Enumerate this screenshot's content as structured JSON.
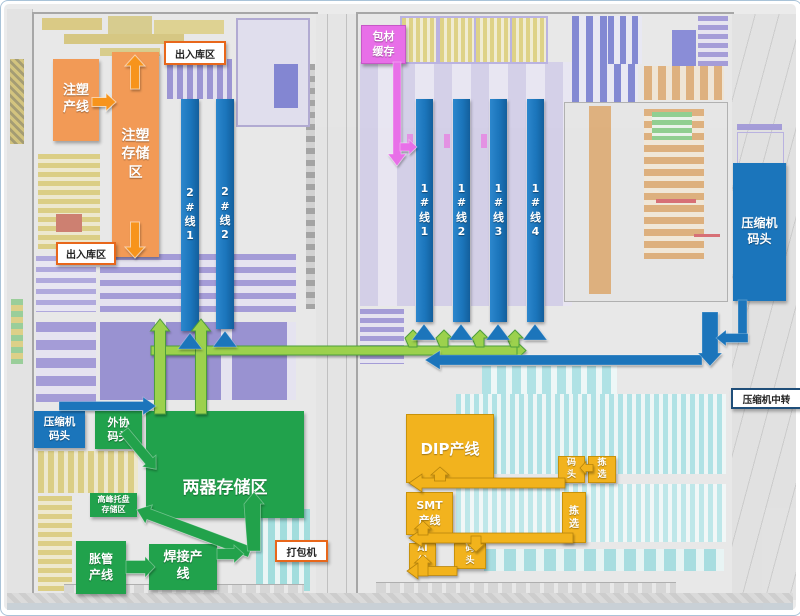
{
  "colors": {
    "orange_box": "#f29a56",
    "orange_arrow": "#f7941d",
    "blue": "#1b75bb",
    "green": "#21a24c",
    "light_green": "#9cd14e",
    "yellow": "#f2b31e",
    "magenta": "#e86fe8",
    "callout_orange": "#e8671b",
    "callout_blue": "#1f4e79"
  },
  "callouts": {
    "inbound_outbound_top": "出入库区",
    "inbound_outbound_bottom": "出入库区",
    "packer": "打包机",
    "compressor_transfer": "压缩机中转"
  },
  "left_building": {
    "injection_line": "注塑产线",
    "injection_storage": "注塑存储区",
    "line2_1": "2#线1",
    "line2_2": "2#线2",
    "compressor_dock": "压缩机码头",
    "external_dock": "外协码头",
    "hx_storage": "两器存储区",
    "peak_pallet_storage": "高峰托盘存储区",
    "tube_expansion_line": "胀管产线",
    "welding_line": "焊接产线"
  },
  "right_building": {
    "packaging_buffer": "包材缓存",
    "line1_1": "1#线1",
    "line1_2": "1#线2",
    "line1_3": "1#线3",
    "line1_4": "1#线4",
    "compressor_dock": "压缩机码头",
    "dip_line": "DIP产线",
    "smt_line": "SMT产线",
    "ai_line": "AI线",
    "dock_upper": "码头",
    "pick_upper": "拣选",
    "pick_lower": "拣选",
    "dock_lower": "码头"
  }
}
